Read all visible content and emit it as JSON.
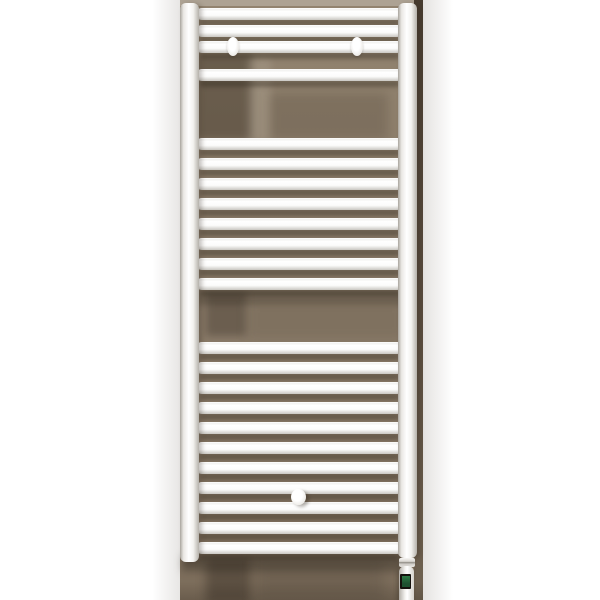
{
  "scene": {
    "description": "Product photo of a white ladder-style electric towel radiator mounted on a taupe wall panel, white margins either side",
    "product": "electric-towel-radiator"
  },
  "colors": {
    "wall": "#8a7b69",
    "wall_top": "#92836f",
    "wall_bottom": "#7b6c5a",
    "wall_edge_dark": "#473c30",
    "display_frame": "#15120e",
    "display_green": "#1d5130",
    "display_green_light": "#2e7a45"
  },
  "backdrop": {
    "x": 180,
    "w": 243
  },
  "radiator": {
    "bar_height": 12,
    "groups": [
      {
        "name": "top",
        "ys": [
          8,
          25,
          41,
          69
        ]
      },
      {
        "name": "middle",
        "ys": [
          138,
          158,
          178,
          198,
          218,
          238,
          258,
          278
        ]
      },
      {
        "name": "bottom",
        "ys": [
          342,
          362,
          382,
          402,
          422,
          442,
          462,
          482,
          502,
          522,
          542
        ]
      }
    ],
    "left_rail": {
      "x": 180,
      "y": 3,
      "h": 559
    },
    "right_rail": {
      "x": 398,
      "y": 3,
      "h": 555
    },
    "brackets": [
      {
        "cx": 233,
        "cy": 46
      },
      {
        "cx": 357,
        "cy": 46
      }
    ],
    "plug": {
      "cx": 298,
      "cy": 497
    },
    "element": {
      "collar": {
        "x": 399,
        "y": 558,
        "w": 16,
        "h": 9
      },
      "body": {
        "x": 399,
        "y": 566,
        "w": 15,
        "h": 34
      },
      "display_frame": {
        "x": 400,
        "y": 574,
        "w": 11,
        "h": 15
      },
      "display_screen": {
        "x": 402,
        "y": 576,
        "w": 8,
        "h": 11
      }
    }
  }
}
